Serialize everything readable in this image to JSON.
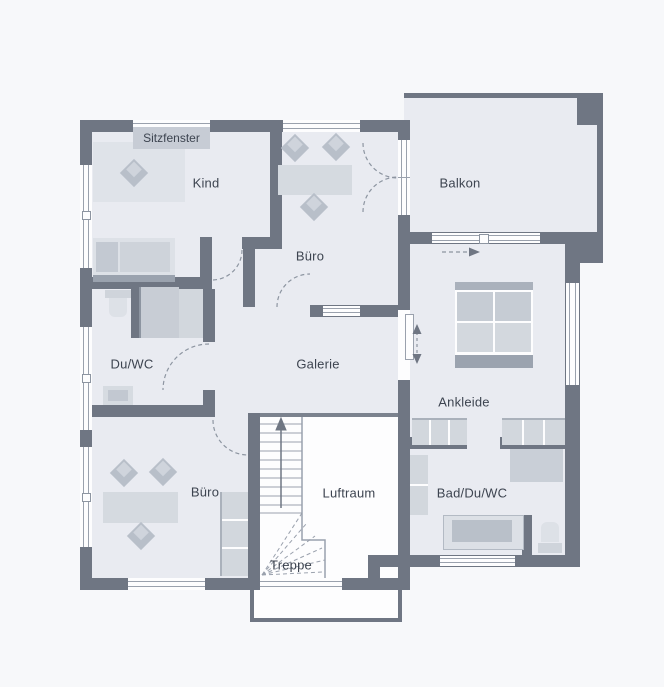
{
  "plan": {
    "title_hint": "floor plan upper storey",
    "rooms": {
      "sitzfenster": "Sitzfenster",
      "kind": "Kind",
      "buero_top": "Büro",
      "balkon": "Balkon",
      "duwc": "Du/WC",
      "galerie": "Galerie",
      "ankleide": "Ankleide",
      "buero_bottom": "Büro",
      "luftraum": "Luftraum",
      "badduwc": "Bad/Du/WC",
      "treppe": "Treppe"
    },
    "colors": {
      "background": "#f7f8fa",
      "wall": "#6f7683",
      "room_fill": "#e9ebf1",
      "void_fill": "#fdfdfe",
      "furniture_light": "#dbdfe6",
      "furniture_mid": "#c5cbd4",
      "furniture_dark": "#a7aeba",
      "text": "#3d4450"
    }
  }
}
